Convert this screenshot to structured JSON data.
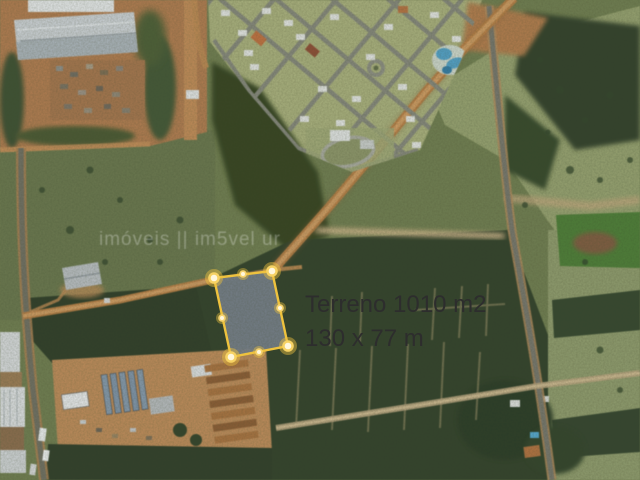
{
  "listing_photo": {
    "watermark": "imóveis || im5vel ur",
    "watermark_color": "#ffffff",
    "parcel": {
      "label_area": "Terreno 1010 m2",
      "label_dimensions": "130 x 77 m",
      "label_text_color": "#2d2d2d",
      "outline_color": "#eec23e",
      "handle_color": "#fff7dc",
      "fill_color": "#767e89"
    }
  }
}
